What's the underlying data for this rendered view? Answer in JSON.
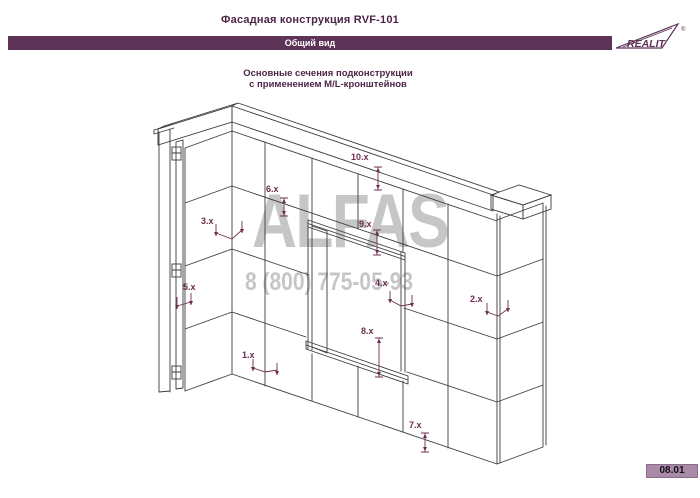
{
  "header": {
    "title": "Фасадная конструкция RVF-101",
    "subtitle": "Общий вид",
    "logo": {
      "text": "REALIT",
      "registered_mark": "®"
    }
  },
  "caption": {
    "line1": "Основные сечения подконструкции",
    "line2": "с применением M/L-кронштейнов"
  },
  "watermark": {
    "line1": "ALFAS",
    "line2": "8 (800) 775-05-93"
  },
  "drawing": {
    "description": "Изометрия фасадной стены с панелями, оконным проёмом и маркерами сечений",
    "section_labels": [
      "1.x",
      "2.x",
      "3.x",
      "4.x",
      "5.x",
      "6.x",
      "7.x",
      "8.x",
      "9.x",
      "10.x"
    ]
  },
  "footer": {
    "page_number": "08.01"
  },
  "colors": {
    "accent": "#4d2547",
    "header_bar": "#5d3357",
    "section_label": "#6e2d51",
    "badge_bg": "#a98ba9",
    "watermark": "#c6c6c6",
    "drawing_line": "#3c3c3c"
  }
}
